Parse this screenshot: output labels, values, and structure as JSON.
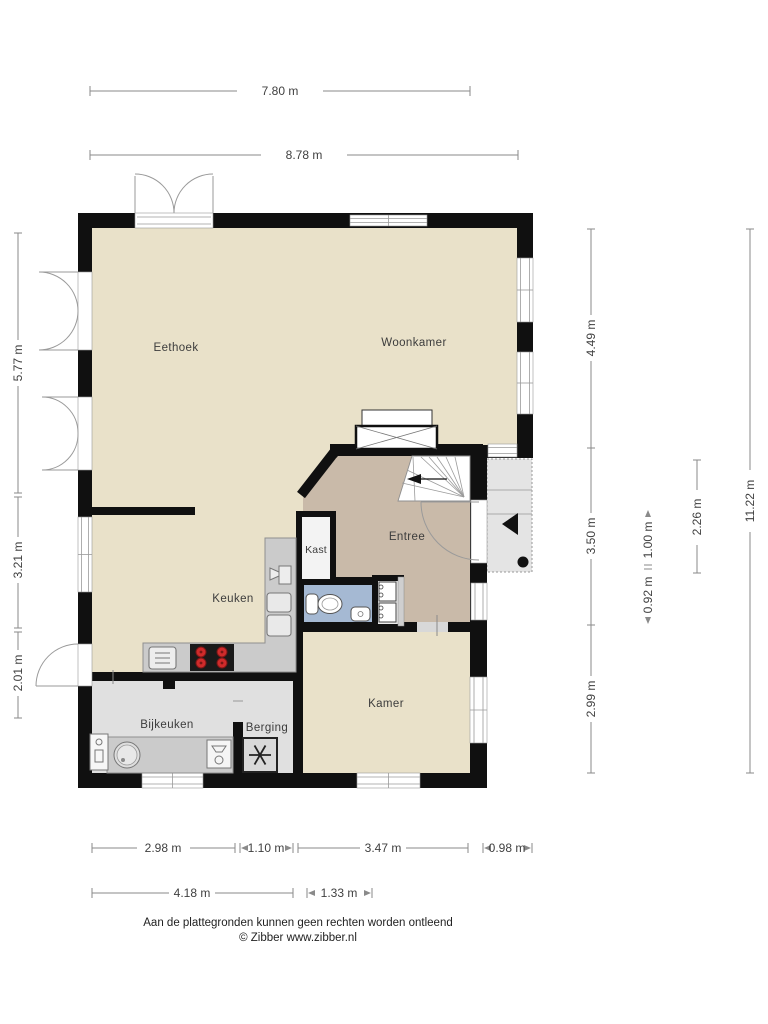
{
  "plan": {
    "rooms": {
      "eethoek": "Eethoek",
      "woonkamer": "Woonkamer",
      "entree": "Entree",
      "kast": "Kast",
      "keuken": "Keuken",
      "kamer": "Kamer",
      "bijkeuken": "Bijkeuken",
      "berging": "Berging"
    },
    "colors": {
      "wall": "#101010",
      "floor_main": "#e9e1c9",
      "floor_entree": "#c9baa9",
      "floor_utility": "#e0e0e0",
      "floor_toilet": "#a5b9d3",
      "floor_kast": "#f3f3f3",
      "counter": "#cbcbcb",
      "porch": "#e4e4e4",
      "burner_red": "#cf2b2b"
    },
    "icons": {
      "stairs_up": "left-arrow-walkline",
      "entrance_marker": "black-triangle-left",
      "entrance_dot": "black-dot",
      "cooktop": "four-red-burners",
      "oven": "square-with-lines",
      "ventilation": "asterisk-fan",
      "wc": "toilet-top-view",
      "sink_round": "round-basin",
      "meters": "meter-cabinet-boxes"
    }
  },
  "dimensions": {
    "top": {
      "w1": "7.80 m",
      "w2": "8.78 m"
    },
    "bottom": {
      "b1": "2.98 m",
      "b2": "1.10 m",
      "b3": "3.47 m",
      "b4": "0.98 m",
      "b5": "4.18 m",
      "b6": "1.33 m"
    },
    "left": {
      "l1": "5.77 m",
      "l2": "3.21 m",
      "l3": "2.01 m"
    },
    "right": {
      "r1": "4.49 m",
      "r2": "3.50 m",
      "r3": "2.99 m",
      "r4": "1.00 m",
      "r5": "0.92 m",
      "r6": "2.26 m",
      "r7": "11.22 m"
    }
  },
  "footer": {
    "disclaimer": "Aan de plattegronden kunnen geen rechten worden ontleend",
    "copyright": "© Zibber www.zibber.nl"
  }
}
